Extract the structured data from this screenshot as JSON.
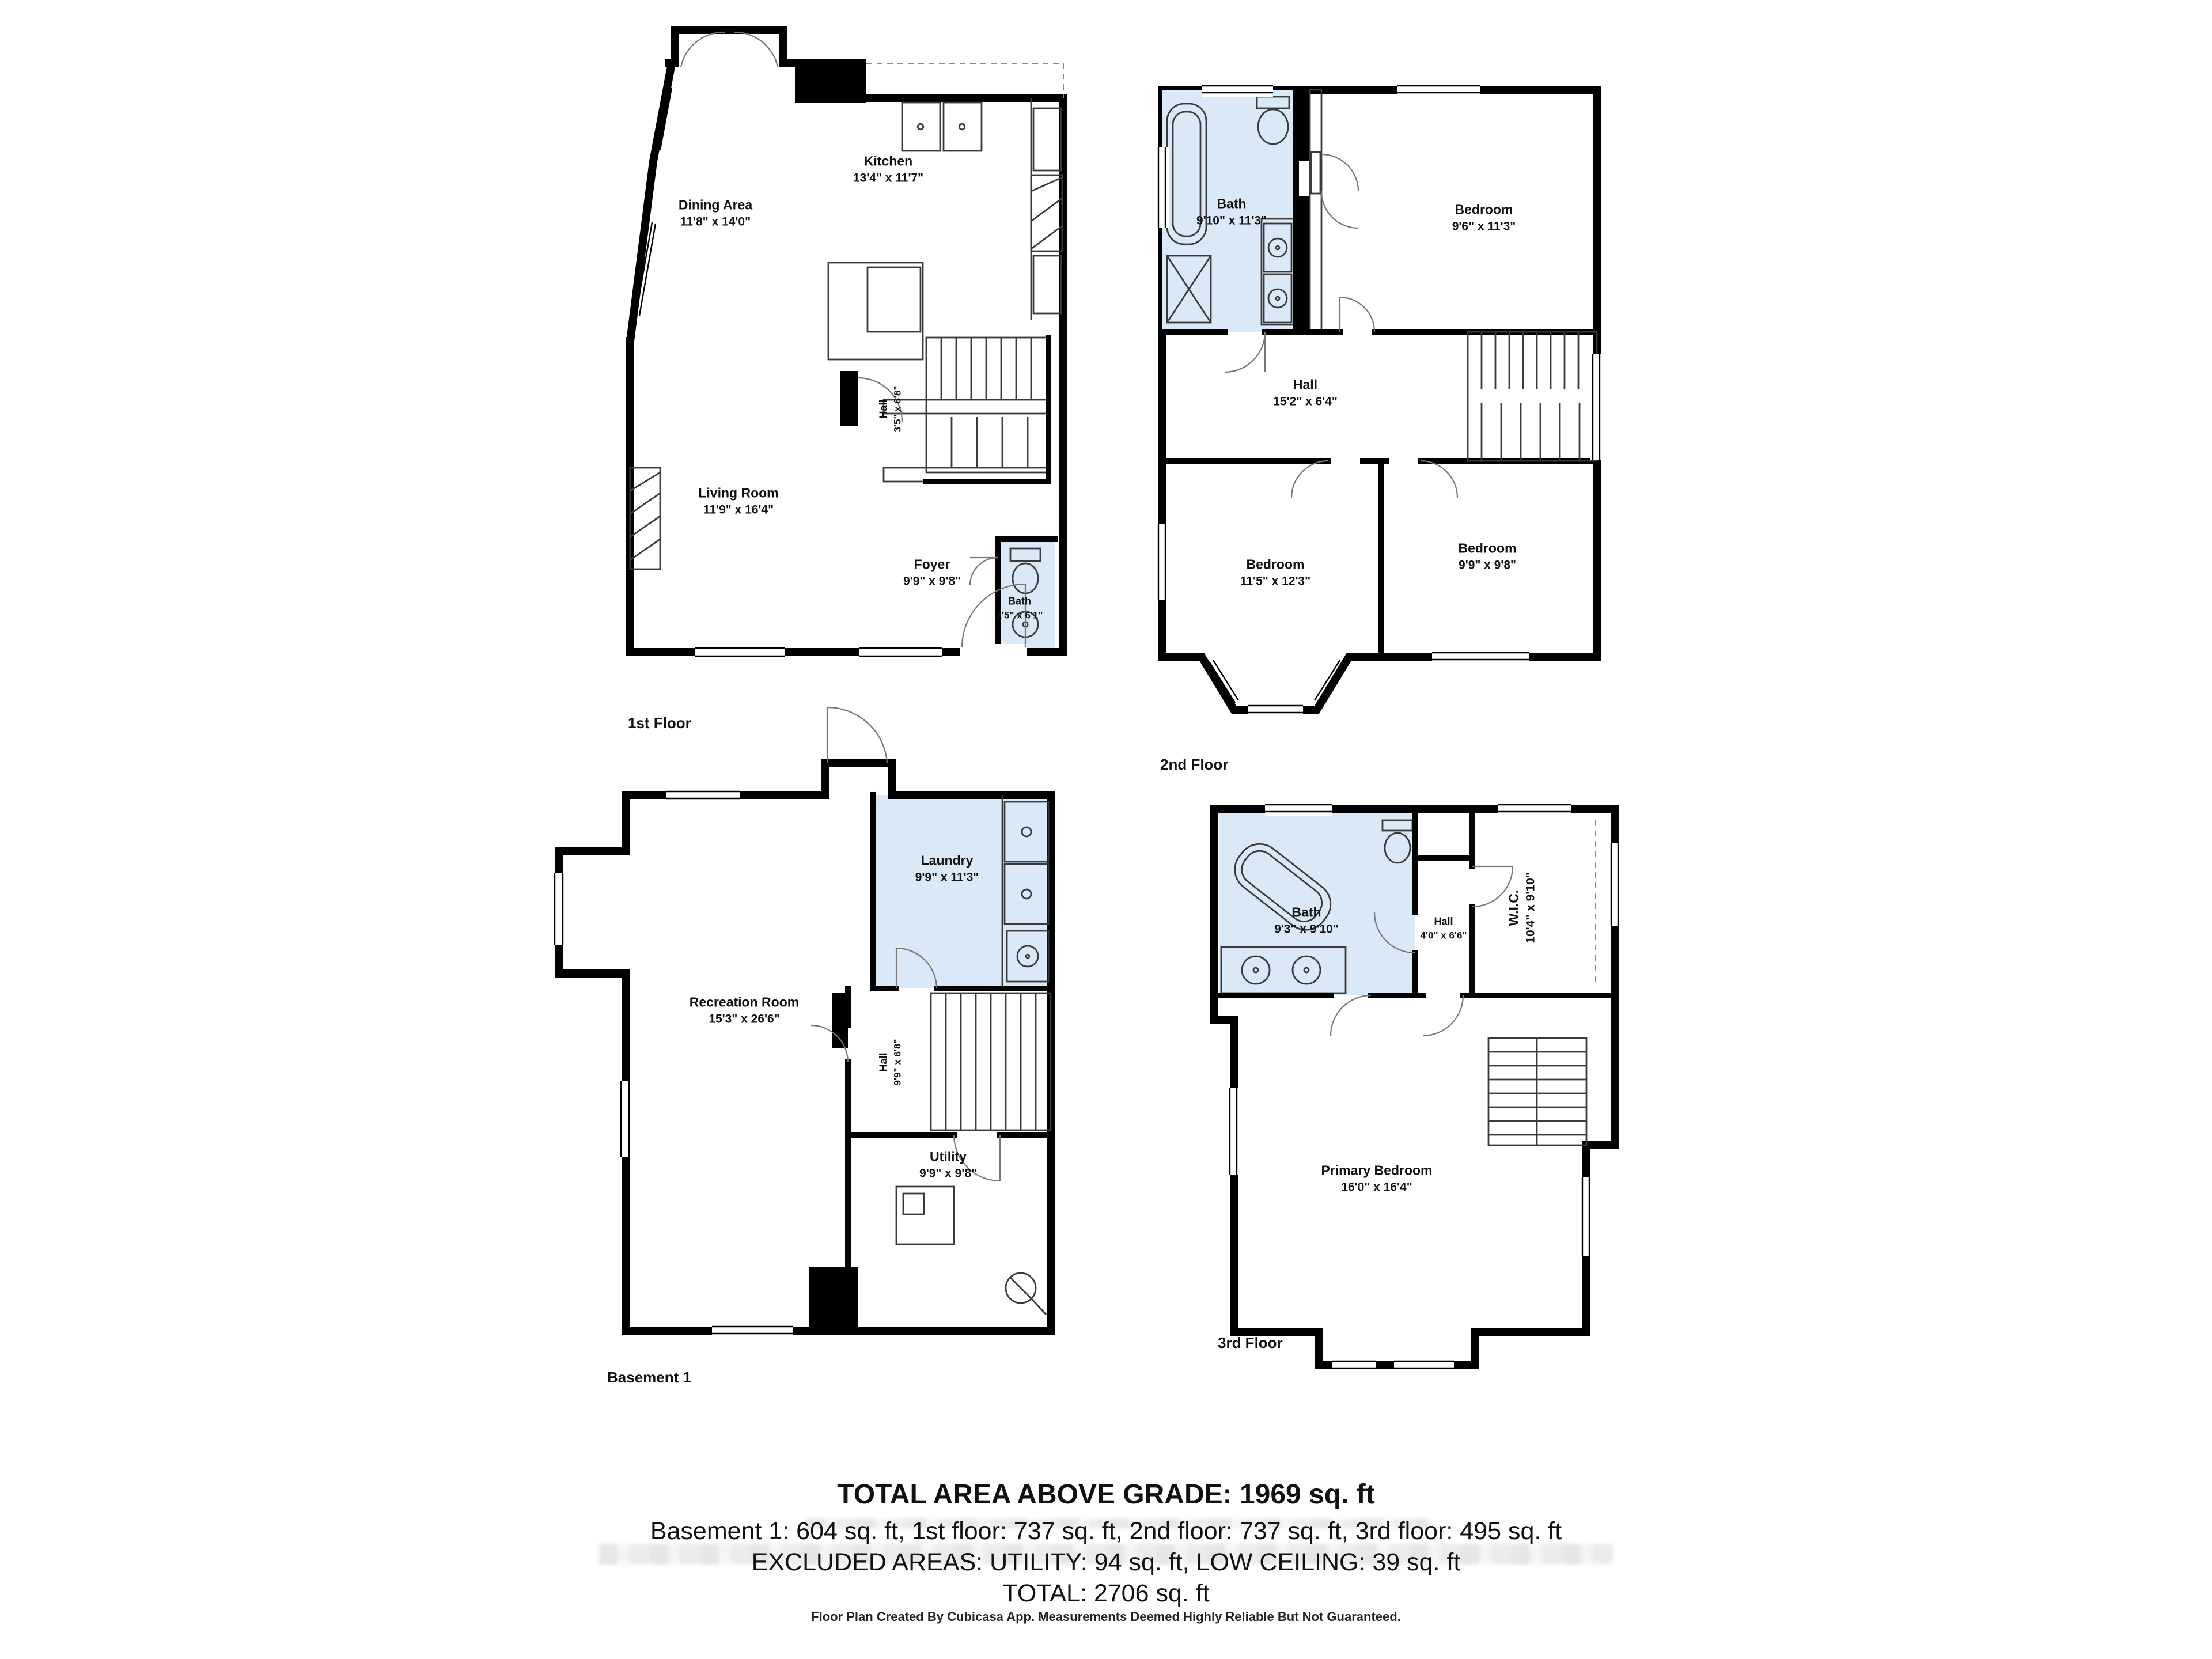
{
  "page": {
    "background": "#ffffff"
  },
  "colors": {
    "wall": "#000000",
    "wet_room_fill": "#d9e9f7",
    "text": "#111111"
  },
  "floors": {
    "first": {
      "label": "1st Floor",
      "rooms": {
        "kitchen": {
          "name": "Kitchen",
          "dims": "13'4\" x 11'7\""
        },
        "dining": {
          "name": "Dining Area",
          "dims": "11'8\" x 14'0\""
        },
        "hall": {
          "name": "Hall",
          "dims": "3'5\" x 6'8\""
        },
        "living": {
          "name": "Living Room",
          "dims": "11'9\" x 16'4\""
        },
        "foyer": {
          "name": "Foyer",
          "dims": "9'9\" x 9'8\""
        },
        "bath": {
          "name": "Bath",
          "dims": "2'5\" x 6'1\""
        }
      }
    },
    "second": {
      "label": "2nd Floor",
      "rooms": {
        "bath": {
          "name": "Bath",
          "dims": "9'10\" x 11'3\""
        },
        "bedroom_tr": {
          "name": "Bedroom",
          "dims": "9'6\" x 11'3\""
        },
        "hall": {
          "name": "Hall",
          "dims": "15'2\" x 6'4\""
        },
        "bedroom_bl": {
          "name": "Bedroom",
          "dims": "11'5\" x 12'3\""
        },
        "bedroom_br": {
          "name": "Bedroom",
          "dims": "9'9\" x 9'8\""
        }
      }
    },
    "basement": {
      "label": "Basement 1",
      "rooms": {
        "laundry": {
          "name": "Laundry",
          "dims": "9'9\" x 11'3\""
        },
        "recreation": {
          "name": "Recreation Room",
          "dims": "15'3\" x 26'6\""
        },
        "hall": {
          "name": "Hall",
          "dims": "9'9\" x 6'8\""
        },
        "utility": {
          "name": "Utility",
          "dims": "9'9\" x 9'8\""
        }
      }
    },
    "third": {
      "label": "3rd Floor",
      "rooms": {
        "bath": {
          "name": "Bath",
          "dims": "9'3\" x 9'10\""
        },
        "hall": {
          "name": "Hall",
          "dims": "4'0\" x 6'6\""
        },
        "wic": {
          "name": "W.I.C.",
          "dims": "10'4\" x 9'10\""
        },
        "primary": {
          "name": "Primary Bedroom",
          "dims": "16'0\" x 16'4\""
        }
      }
    }
  },
  "summary": {
    "title": "TOTAL AREA ABOVE GRADE: 1969 sq. ft",
    "breakdown": "Basement 1: 604 sq. ft, 1st floor: 737 sq. ft, 2nd floor: 737 sq. ft, 3rd floor: 495 sq. ft",
    "excluded": "EXCLUDED AREAS: UTILITY: 94 sq. ft, LOW CEILING: 39 sq. ft",
    "total": "TOTAL: 2706 sq. ft",
    "disclaimer": "Floor Plan Created By Cubicasa App. Measurements Deemed Highly Reliable But Not Guaranteed."
  }
}
